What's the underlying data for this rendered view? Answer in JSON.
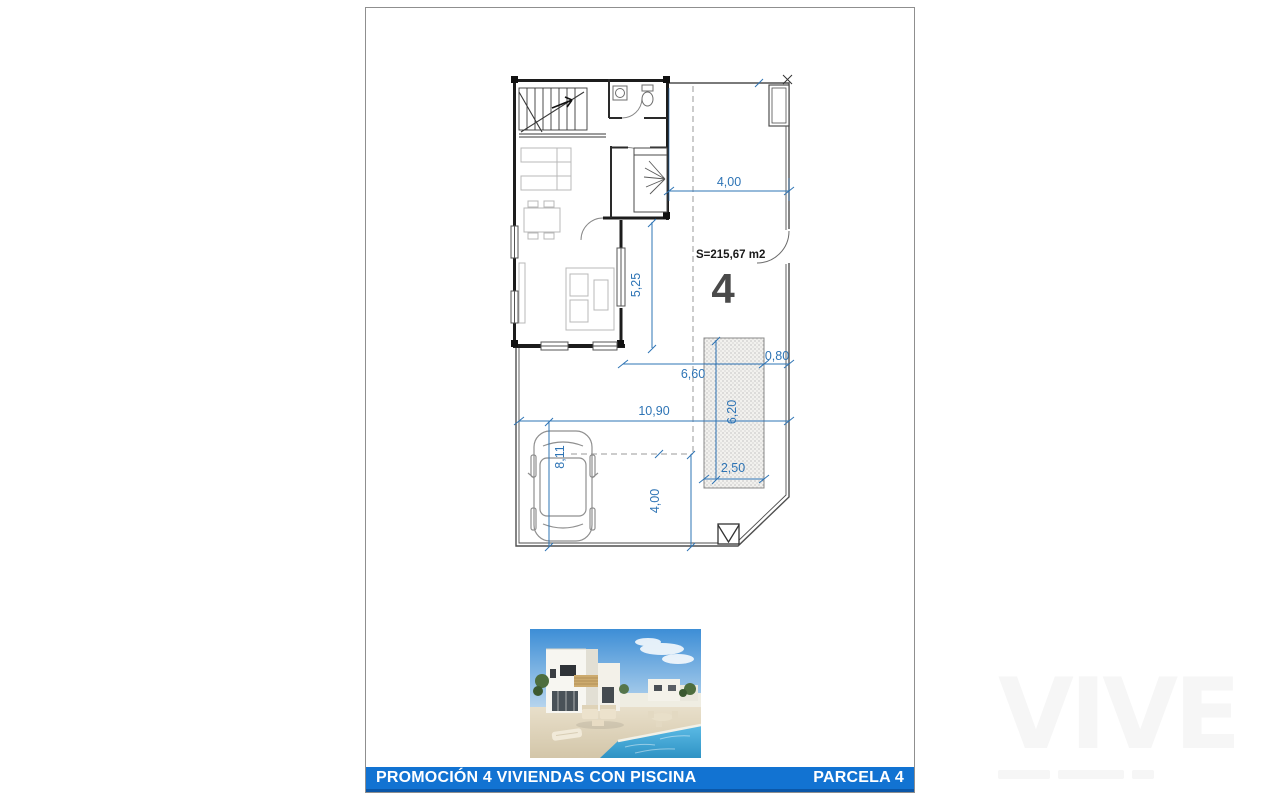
{
  "page": {
    "plan": {
      "area_label": "S=215,67 m2",
      "parcel_number": "4",
      "dimensions": {
        "top_setback": "4,00",
        "terrace_depth": "5,25",
        "rear_yard_width": "6,60",
        "pool_side_offset": "0,80",
        "plot_width": "10,90",
        "driveway_depth": "8,11",
        "pool_length": "6,20",
        "pool_width": "2,50",
        "front_setback": "4,00"
      }
    },
    "footer": {
      "left_label": "PROMOCIÓN 4 VIVIENDAS CON PISCINA",
      "right_label": "PARCELA 4"
    },
    "watermark": {
      "text": "VIVE"
    },
    "colors": {
      "dimension_blue": "#2e74b5",
      "footer_bar": "#1273d2",
      "footer_edge": "#0b57a8",
      "page_border": "#8f8f8f",
      "pool_water": "#45a8d8"
    }
  }
}
